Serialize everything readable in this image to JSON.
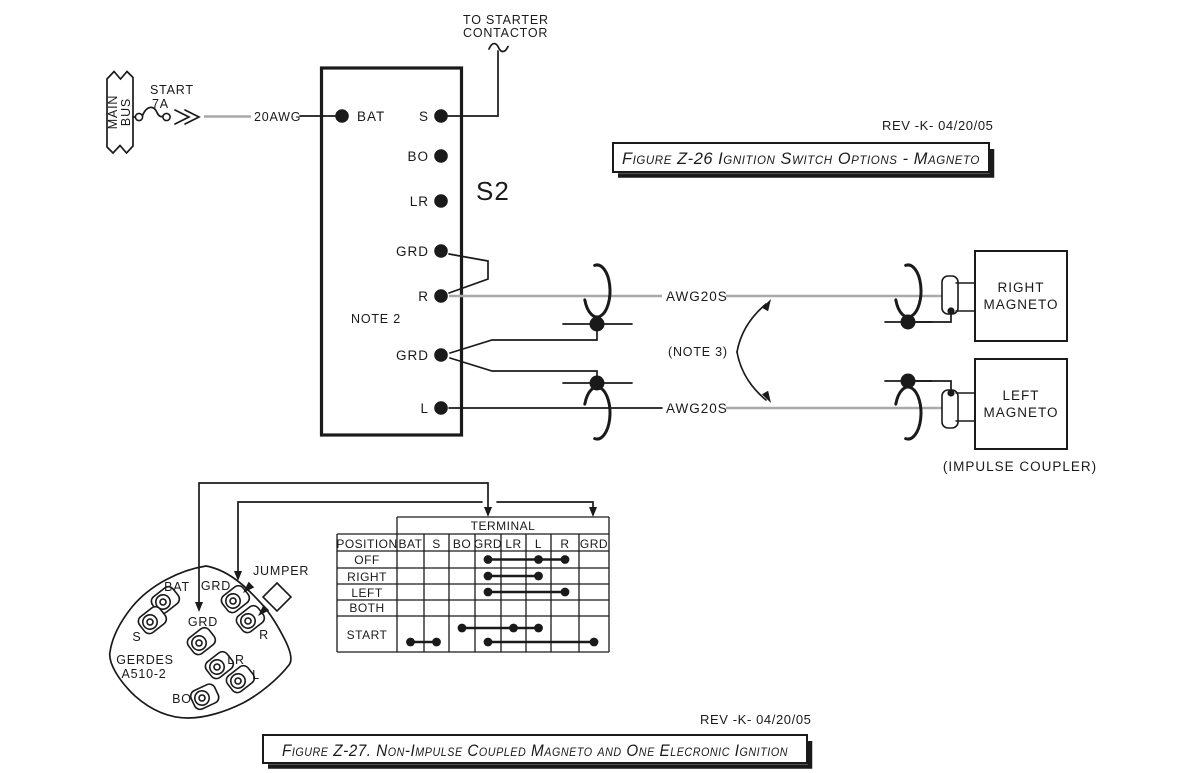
{
  "colors": {
    "ink": "#1a1a1a",
    "wire": "#a9a9a9",
    "paper": "#ffffff"
  },
  "starter_note": {
    "line1": "TO STARTER",
    "line2": "CONTACTOR"
  },
  "bus": {
    "name_line1": "MAIN",
    "name_line2": "BUS",
    "breaker_label": "START",
    "breaker_rating": "7A",
    "wire_gauge": "20AWG"
  },
  "ignition_switch": {
    "designator": "S2",
    "note": "NOTE 2",
    "bat": "BAT",
    "s": "S",
    "bo": "BO",
    "lr": "LR",
    "grd_upper": "GRD",
    "r": "R",
    "grd_lower": "GRD",
    "l": "L"
  },
  "revision_top": "REV -K- 04/20/05",
  "revision_bottom": "REV -K- 04/20/05",
  "figure_z26_title": "Figure Z-26 Ignition Switch Options - Magneto",
  "figure_z27_title": "Figure Z-27. Non-Impulse Coupled Magneto and One Elecronic Ignition",
  "wiring": {
    "right_gauge": "AWG20S",
    "left_gauge": "AWG20S",
    "note3": "(NOTE 3)",
    "impulse_note": "(IMPULSE COUPLER)"
  },
  "right_magneto": {
    "line1": "RIGHT",
    "line2": "MAGNETO"
  },
  "left_magneto": {
    "line1": "LEFT",
    "line2": "MAGNETO"
  },
  "connector": {
    "maker": "GERDES",
    "part": "A510-2",
    "jumper": "JUMPER",
    "bat": "BAT",
    "grd_top": "GRD",
    "grd_center": "GRD",
    "s": "S",
    "r": "R",
    "lr": "LR",
    "l": "L",
    "bo": "BO"
  },
  "switch_table": {
    "title": "TERMINAL",
    "position_header": "POSITION",
    "terminal_headers": [
      "BAT",
      "S",
      "BO",
      "GRD",
      "LR",
      "L",
      "R",
      "GRD"
    ],
    "positions": [
      "OFF",
      "RIGHT",
      "LEFT",
      "BOTH",
      "START"
    ],
    "connections": [
      {
        "position": "OFF",
        "level": "main",
        "terminals": [
          "GRD",
          "L",
          "R"
        ],
        "cols": [
          3,
          5,
          6
        ]
      },
      {
        "position": "RIGHT",
        "level": "main",
        "terminals": [
          "GRD",
          "L"
        ],
        "cols": [
          3,
          5
        ]
      },
      {
        "position": "LEFT",
        "level": "main",
        "terminals": [
          "GRD",
          "R"
        ],
        "cols": [
          3,
          6
        ]
      },
      {
        "position": "BOTH",
        "level": "main",
        "terminals": [],
        "cols": []
      },
      {
        "position": "START",
        "level": "upper",
        "terminals": [
          "BO",
          "LR",
          "L"
        ],
        "cols": [
          2,
          4,
          5
        ]
      },
      {
        "position": "START",
        "level": "lower",
        "terminals": [
          "BAT",
          "S"
        ],
        "cols": [
          0,
          1
        ]
      },
      {
        "position": "START",
        "level": "lower",
        "terminals": [
          "GRD",
          "GRD"
        ],
        "cols": [
          3,
          7
        ]
      }
    ]
  }
}
